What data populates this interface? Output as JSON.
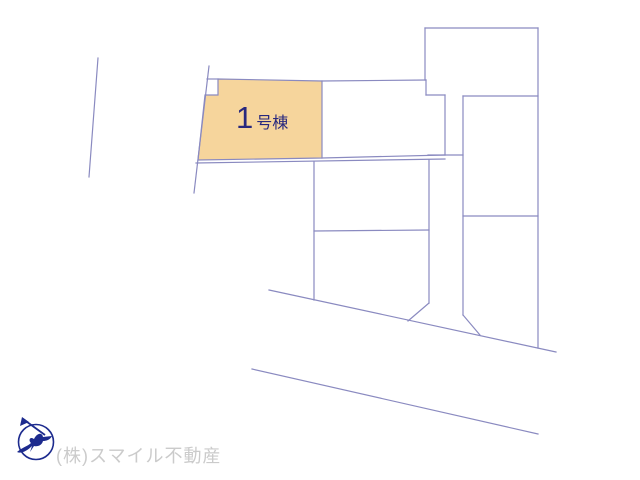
{
  "colors": {
    "background": "#ffffff",
    "line": "#8a8ac0",
    "parcel_fill": "#f6d59c",
    "label_text": "#28287e",
    "compass": "#1d2b8e",
    "watermark_text": "#cbcbcb"
  },
  "map": {
    "highlighted_parcel": {
      "label_number": "1",
      "label_suffix": "号棟",
      "points": "218,79 322,81 322,158 198,160 205,95 218,95"
    },
    "segments": [
      [
        98,
        58,
        89,
        177
      ],
      [
        209,
        66,
        194,
        193
      ],
      [
        207,
        79,
        218,
        79
      ],
      [
        322,
        81,
        426,
        80
      ],
      [
        426,
        80,
        426,
        95
      ],
      [
        426,
        95,
        445,
        95
      ],
      [
        445,
        95,
        445,
        155
      ],
      [
        428,
        155,
        463,
        155
      ],
      [
        322,
        158,
        445,
        155
      ],
      [
        196,
        163,
        445,
        159
      ],
      [
        314,
        162,
        314,
        300
      ],
      [
        429,
        160,
        429,
        303
      ],
      [
        314,
        231,
        429,
        230
      ],
      [
        429,
        303,
        408,
        321
      ],
      [
        269,
        290,
        556,
        352
      ],
      [
        252,
        369,
        538,
        434
      ],
      [
        463,
        96,
        463,
        315
      ],
      [
        463,
        315,
        480,
        335
      ],
      [
        463,
        96,
        538,
        96
      ],
      [
        463,
        216,
        538,
        216
      ],
      [
        538,
        28,
        538,
        348
      ],
      [
        425,
        28,
        538,
        28
      ],
      [
        425,
        28,
        425,
        80
      ]
    ]
  },
  "footer": {
    "company": "(株)スマイル不動産"
  },
  "icons": {
    "compass_north": "bird-north-arrow-in-circle"
  }
}
